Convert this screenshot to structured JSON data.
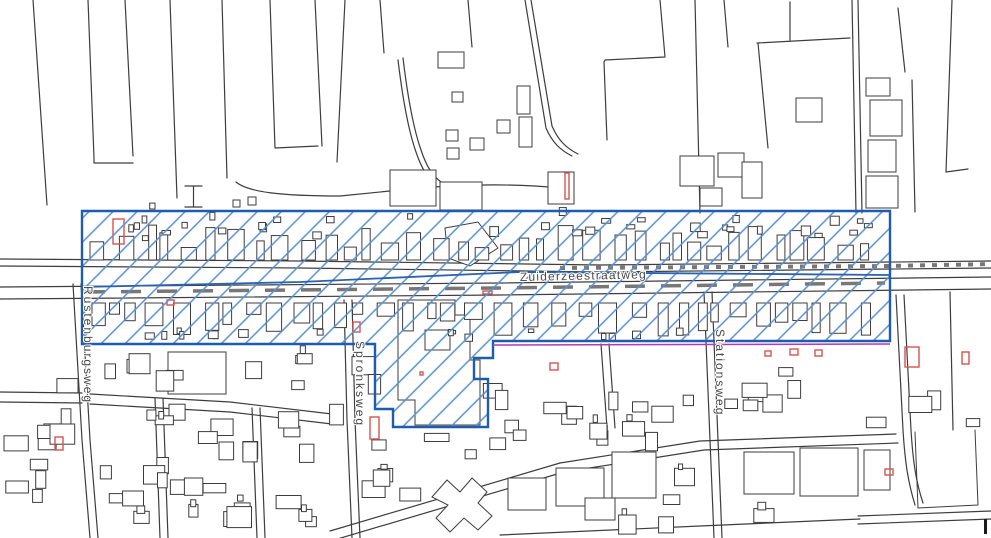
{
  "map": {
    "description": "Scanned cadastral line map of a village along the Zuiderzeestraatweg with a blue hatched project-area overlay",
    "street_labels": {
      "main_road": "Zuiderzeestraatweg",
      "west_street": "Rustenburgsweg",
      "center_street": "Spronksweg",
      "east_street": "Stationsweg"
    },
    "overlay": {
      "name": "hatched project area",
      "border_color": "#1e5cae",
      "hatch_color": "#5a8fd0",
      "inner_line_color": "#2b62b0",
      "secondary_line_color": "#b23ab5"
    },
    "base_colors": {
      "line": "#3d3d3d",
      "highlight_building": "#d9534f",
      "label_text": "#4a4a4a",
      "background": "#ffffff"
    }
  }
}
